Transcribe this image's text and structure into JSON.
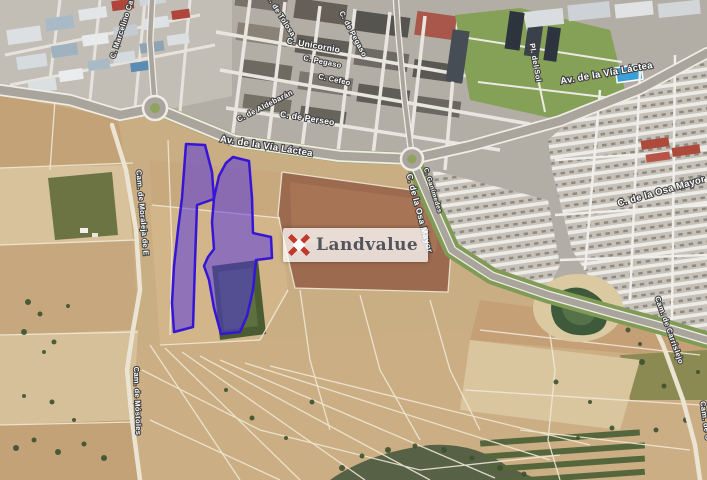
{
  "watermark": {
    "text": "Landvalue",
    "icon": "landvalue-cross-icon",
    "icon_color": "#c0392b",
    "bg_color": "rgba(255,255,255,0.75)",
    "text_color": "#53555e"
  },
  "map": {
    "type": "satellite",
    "highlighted_parcels": 2,
    "parcel": {
      "fill": "rgba(76,46,228,0.5)",
      "stroke": "#3516d6"
    },
    "street_labels": [
      {
        "text": "C. Marcelino Ca",
        "x": 124,
        "y": 30,
        "angle": -72,
        "size": 7.5
      },
      {
        "text": "C. de Tolosa",
        "x": 279,
        "y": 17,
        "angle": 58,
        "size": 7.5
      },
      {
        "text": "C. Unicornio",
        "x": 313,
        "y": 48,
        "angle": 10,
        "size": 8.5
      },
      {
        "text": "C. de Pegaso",
        "x": 351,
        "y": 35,
        "angle": 62,
        "size": 7.5
      },
      {
        "text": "C. Pegaso",
        "x": 322,
        "y": 64,
        "angle": 12,
        "size": 7.5
      },
      {
        "text": "C. Cefeo",
        "x": 334,
        "y": 82,
        "angle": 12,
        "size": 7.5
      },
      {
        "text": "C. de Aldebarán",
        "x": 266,
        "y": 108,
        "angle": -27,
        "size": 7.5
      },
      {
        "text": "C. de Perseo",
        "x": 307,
        "y": 121,
        "angle": 9,
        "size": 8.5
      },
      {
        "text": "Av. de la Vía Láctea",
        "x": 266,
        "y": 149,
        "angle": 9,
        "size": 9.5
      },
      {
        "text": "Av. de la Vía Láctea",
        "x": 607,
        "y": 76,
        "angle": -10,
        "size": 9.5
      },
      {
        "text": "Pl. del Sol",
        "x": 533,
        "y": 63,
        "angle": 80,
        "size": 7.5
      },
      {
        "text": "C. Ganímedes",
        "x": 431,
        "y": 191,
        "angle": 72,
        "size": 6.5
      },
      {
        "text": "C. de la Osa Mayor",
        "x": 417,
        "y": 214,
        "angle": 75,
        "size": 8.5
      },
      {
        "text": "C. de la Osa Mayor",
        "x": 662,
        "y": 194,
        "angle": -16,
        "size": 9.5
      },
      {
        "text": "Cam. de Moraleja de E",
        "x": 140,
        "y": 213,
        "angle": 85,
        "size": 7.5
      },
      {
        "text": "Cam. de Móstoles",
        "x": 135,
        "y": 401,
        "angle": 88,
        "size": 7.5
      },
      {
        "text": "Cam. de Carrislejo",
        "x": 667,
        "y": 331,
        "angle": 70,
        "size": 7.5
      },
      {
        "text": "Cam. de C",
        "x": 703,
        "y": 421,
        "angle": 82,
        "size": 7.5
      }
    ]
  }
}
